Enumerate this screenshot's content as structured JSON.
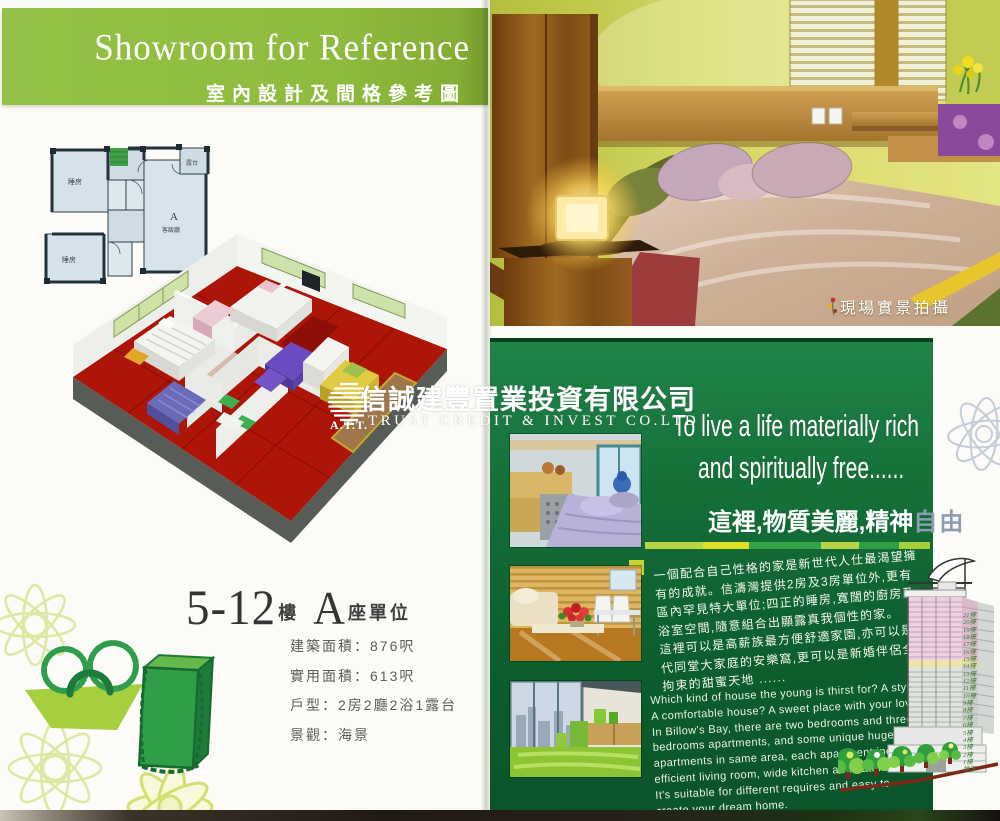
{
  "left_page": {
    "banner": {
      "title_en": "Showroom for Reference",
      "title_zh": "室內設計及間格參考圖"
    },
    "floor_plan": {
      "bedroom_top": "睡房",
      "bedroom_bottom": "睡房",
      "unit_letter": "A",
      "living_room": "客飯廳",
      "balcony": "露台"
    },
    "unit_title": {
      "floor_range": "5-12",
      "floor_suffix": "樓",
      "block_letter": "A",
      "block_suffix": "座單位"
    },
    "specs": [
      "建築面積：876呎",
      "實用面積：613呎",
      "戶型：2房2廳2浴1露台",
      "景觀：海景"
    ]
  },
  "watermark": {
    "logo_text": "A.T.T.",
    "company_zh": "信誠建豐置業投資有限公司",
    "company_en": "TRUST CREDIT & INVEST CO.LTD"
  },
  "right_page": {
    "photo_caption": "現場實景拍攝",
    "headline": {
      "line1": "To live a life materially rich",
      "line2": "and spiritually free......"
    },
    "subheadline": {
      "white_part": "這裡,物質美麗,精神",
      "grey_part": "自由",
      "grey_color": "#8c9db2"
    },
    "paragraph_zh_lines": [
      "一個配合自己性格的家是新世代人仕最渴望擁",
      "有的成就。信濤灣提供2房及3房單位外,更有",
      "區內罕見特大單位;四正的睡房,寬闊的廚房及",
      "浴室空間,隨意組合出顯露真我個性的家。",
      "這裡可以是高薪族最方便舒適家園,亦可以是數",
      "代同堂大家庭的安樂窩,更可以是新婚伴侶全無",
      "拘束的甜蜜天地 ......"
    ],
    "paragraph_en_lines": [
      "Which kind of house the young is thirst for? A stylish house?",
      "A comfortable house?  A sweet place with your lover?",
      "In Billow's Bay, there are two bedrooms and three",
      "bedrooms apartments, and some unique huge",
      "apartments in same area, each apartment included",
      "efficient living room, wide kitchen and bathroom.",
      "It's suitable for different requires and easy to",
      "create your dream home."
    ],
    "building_floors": [
      "21樓",
      "20樓",
      "19樓",
      "18樓",
      "17樓",
      "16樓",
      "15樓",
      "14樓",
      "13樓",
      "12樓",
      "11樓",
      "10樓",
      "9樓",
      "8樓",
      "7樓",
      "6樓",
      "5樓",
      "4樓",
      "3樓",
      "2樓",
      "1樓",
      "地下"
    ]
  },
  "colors": {
    "banner_green": "#8eba3d",
    "page_green_top": "#20834a",
    "page_green_bottom": "#0a5429",
    "accent_yellow": "#dfe224",
    "accent_light_green": "#b8d449",
    "carpet_red": "#ae1509",
    "floor_label_green": "#41803a"
  }
}
